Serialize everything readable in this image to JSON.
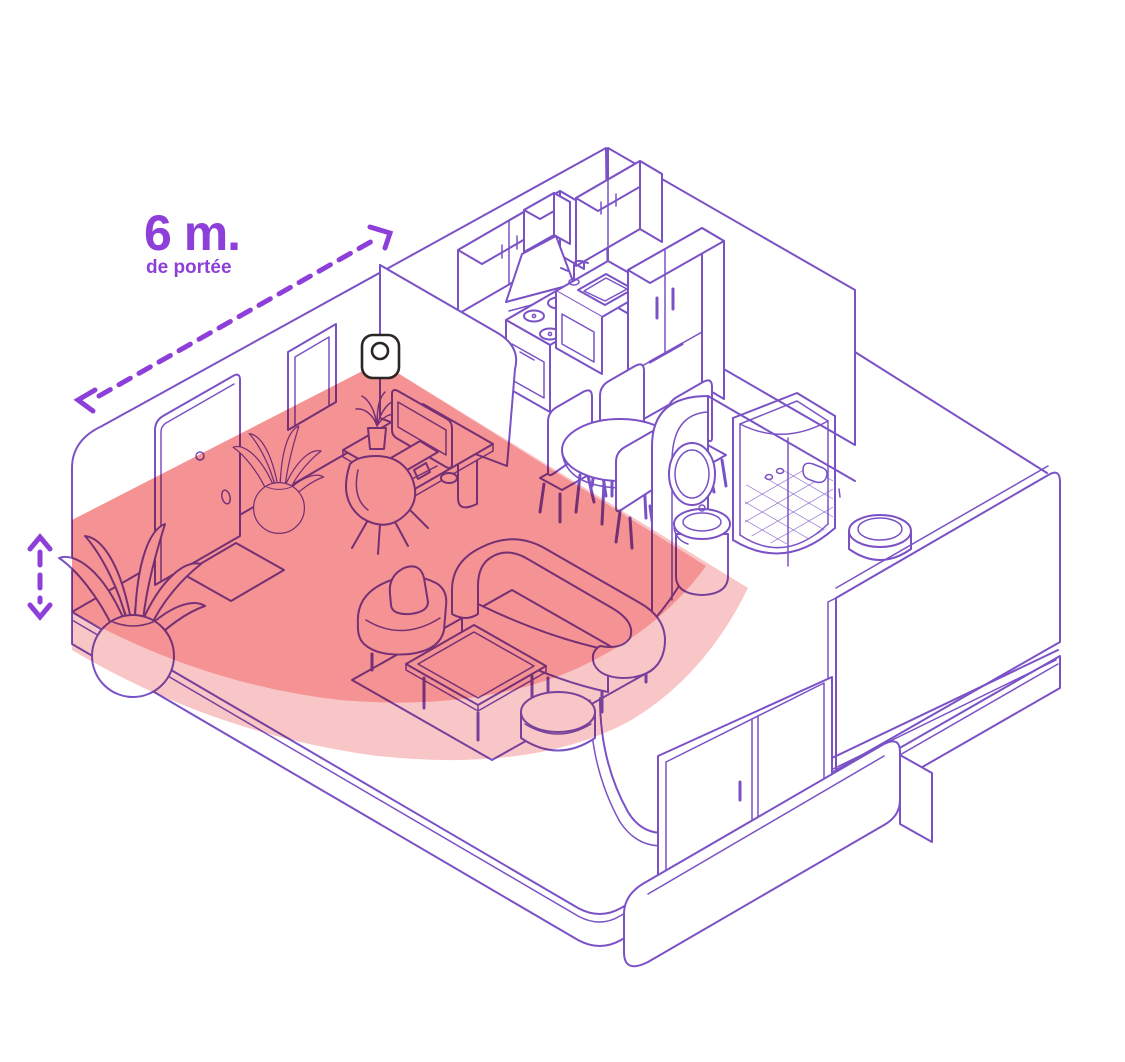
{
  "illustration": {
    "range_label": {
      "value": "6 m.",
      "caption": "de portée"
    },
    "colors": {
      "outline_purple": "#7a52c6",
      "accent_purple": "#8e3fd9",
      "zone_inner_red": "#f59294",
      "zone_outer_pink": "#f9c6c7",
      "sensor_outline": "#2b2523",
      "background": "#ffffff"
    },
    "objects": [
      "motion-sensor",
      "detection-zone",
      "front-door",
      "doormat",
      "picture-frame",
      "floor-plant-large",
      "floor-plant-small",
      "desk",
      "imac-computer",
      "keyboard",
      "mouse",
      "desk-plant",
      "desk-chair",
      "armchair",
      "curved-sofa",
      "coffee-table",
      "rug",
      "pouf",
      "wall-cabinet-left",
      "wall-cabinet-right",
      "extractor-hood",
      "stove",
      "kitchen-sink",
      "refrigerator",
      "dining-table",
      "dining-chair",
      "bathroom-wall",
      "bathroom-mirror",
      "pedestal-sink",
      "corner-shower",
      "toilet",
      "brick-wall",
      "sliding-window",
      "balcony-planter"
    ]
  }
}
